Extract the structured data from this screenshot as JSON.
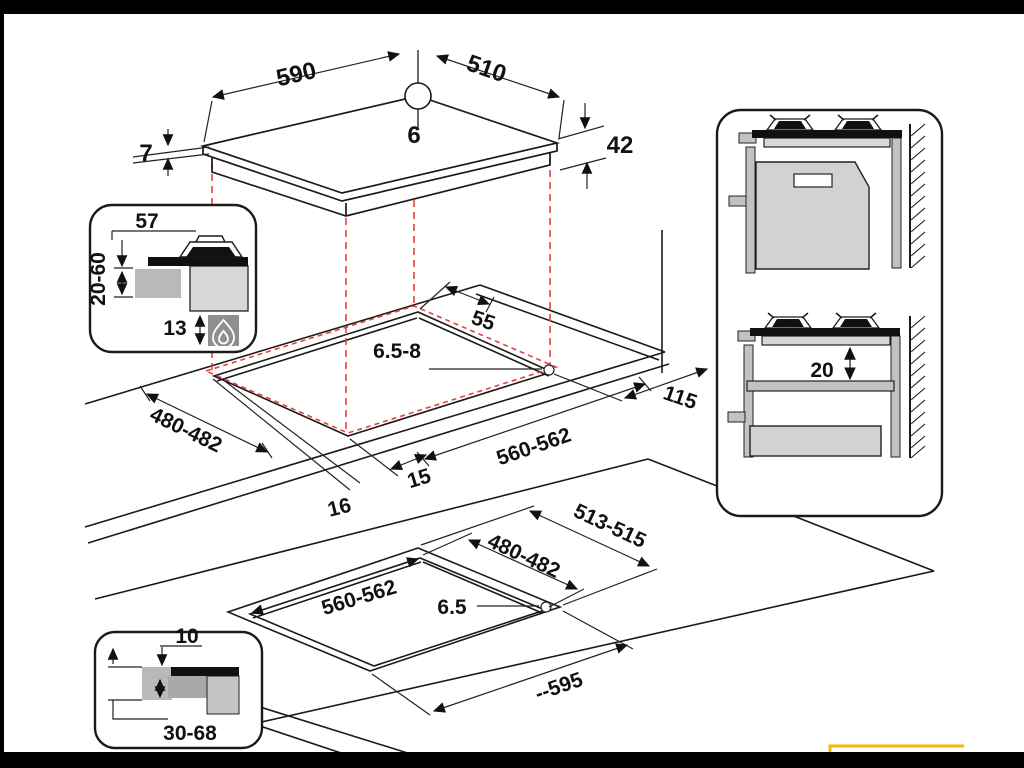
{
  "diagram": {
    "kind": "hob-installation-dimension-drawing",
    "colors": {
      "line": "#1a1a1a",
      "projection_red": "#e8413c",
      "gray_mid": "#b9b9b9",
      "gray_light": "#d7d7d7",
      "gray_dark": "#8f8f8f",
      "accent_yellow": "#f2b40d",
      "frame": "#000000"
    },
    "labels": {
      "hob": {
        "width": "590",
        "depth": "510",
        "hole": "6",
        "glass": "7",
        "body": "42"
      },
      "burner_inset": {
        "cap": "57",
        "range": "20-60",
        "below": "13"
      },
      "cutout": {
        "back_gap": "55",
        "hole": "6.5-8",
        "side_gap": "115",
        "cut_depth": "480-482",
        "cut_width": "560-562",
        "front_a": "15",
        "front_b": "16"
      },
      "flush": {
        "outer_depth": "513-515",
        "cut_depth": "480-482",
        "cut_width": "560-562",
        "hole": "6.5",
        "outer_width": "--595"
      },
      "flush_inset": {
        "step": "10",
        "range": "30-68"
      },
      "wall_section": {
        "shelf_gap": "20"
      }
    }
  }
}
